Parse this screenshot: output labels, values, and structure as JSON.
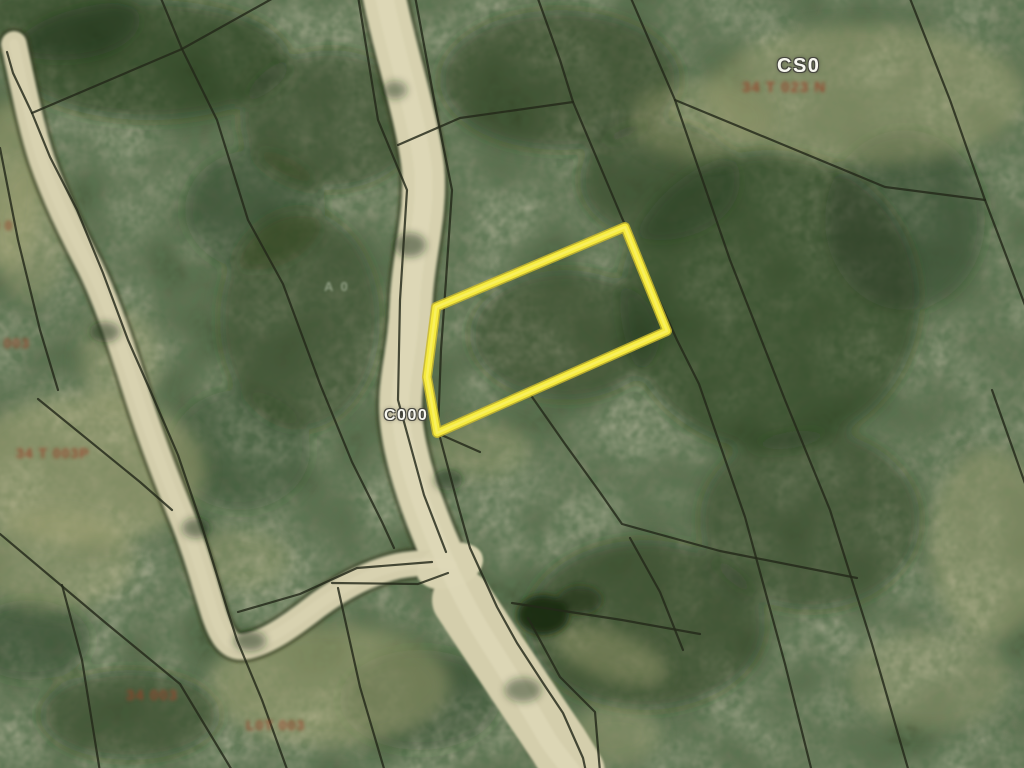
{
  "map": {
    "colors": {
      "highlight_yellow": "#f5ea3d",
      "highlight_yellow_edge": "#c9b92f",
      "road_tan": "#d7d1af",
      "boundary_line": "#23281a",
      "parcel_label_red": "#97422a",
      "road_label_white": "#f7f7ef",
      "forest_base": "#42553a",
      "pond_dark": "#1a2a12"
    },
    "highlight_parcel": {
      "points": "436,307 625,227 667,331 437,433 427,377"
    },
    "pond": {
      "cx": 543,
      "cy": 615,
      "rx": 26,
      "ry": 20
    },
    "roads": {
      "main_d": "M383,-10 C393,45 417,115 423,168 C427,215 413,255 411,305 C409,355 398,382 401,418 C404,452 416,492 436,540 C452,578 468,610 487,640 C510,676 532,712 548,740 C556,752 565,762 572,772",
      "main_tail_d": "M462,600 C495,650 528,700 558,744 L575,772",
      "left_spur_d": "M14,44 C25,95 32,130 42,160 C55,198 72,232 90,267 C105,297 120,340 135,388 C150,436 165,475 180,512 C195,548 205,585 214,614 C222,638 230,650 248,646 C270,641 292,625 318,605 C344,586 372,572 398,566 C420,562 438,562 452,565"
    },
    "parcel_lines": [
      "M160,-4 L182,49",
      "M277,-4 L182,49",
      "M182,49 L32,113",
      "M182,49 L217,120 L248,220 L283,284 L320,384 L352,462 L382,522 L394,548",
      "M7,52 L13,73 L32,113 L50,157 L77,210 L103,273 L128,340 L150,390 L178,455 L200,520 L216,572 L228,612 L237,640 L262,700 L288,772",
      "M0,148 L18,240 L40,330 L58,390",
      "M38,399 L140,482 L172,510",
      "M0,534 L107,624 L180,684 L233,772",
      "M62,585 L82,660 L100,772",
      "M238,612 L300,594 L357,568 L432,562",
      "M338,588 L360,687 L385,772",
      "M358,-4 L378,120 L407,190 L400,300 L398,400 L424,495 L446,552",
      "M415,-4 L436,110 L452,190 L446,280 L441,350 L438,430 L458,505 L470,548 L497,607 L517,643 L543,683 L563,713 L583,758 L586,772",
      "M398,145 L460,118 L573,102",
      "M537,-4 L560,60 L573,102 L622,218 L677,340 L699,384 L745,517 L785,664 L812,772",
      "M630,-4 L675,100 L730,260 L785,400 L830,510 L872,644 L909,772",
      "M909,-4 L950,100 L985,200 L1028,313",
      "M675,100 L779,143 L885,187 L985,200",
      "M530,394 L565,444 L599,491 L622,524 L720,551 L857,578",
      "M512,603 L622,620 L700,634",
      "M630,538 L660,592 L683,650",
      "M992,390 L1028,492",
      "M437,433 L480,452",
      "M528,618 L560,677 L588,705 L595,712 L600,772",
      "M332,583 L418,584 L448,573"
    ],
    "labels": [
      {
        "text": "CS0",
        "kind": "road",
        "x": 777,
        "y": 56,
        "size": 20
      },
      {
        "text": "C000",
        "kind": "road",
        "x": 384,
        "y": 408,
        "size": 16
      },
      {
        "text": "A 0",
        "kind": "faint",
        "x": 324,
        "y": 280,
        "size": 13
      },
      {
        "text": "34 T 023 N",
        "kind": "parcel",
        "x": 742,
        "y": 80,
        "size": 15
      },
      {
        "text": "0 0",
        "kind": "parcel",
        "x": -8,
        "y": 219,
        "size": 13
      },
      {
        "text": "0 003",
        "kind": "parcel",
        "x": -10,
        "y": 336,
        "size": 14
      },
      {
        "text": "34 T 003P",
        "kind": "parcel",
        "x": 16,
        "y": 446,
        "size": 14
      },
      {
        "text": "34 003",
        "kind": "parcel",
        "x": 126,
        "y": 688,
        "size": 15
      },
      {
        "text": "L0T 003",
        "kind": "parcel",
        "x": 246,
        "y": 718,
        "size": 14
      }
    ]
  }
}
